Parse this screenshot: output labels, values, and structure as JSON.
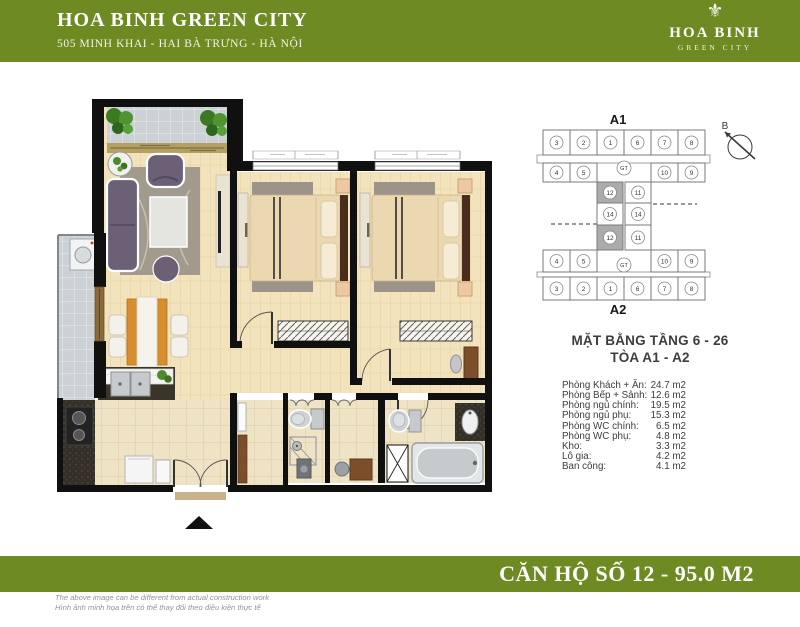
{
  "header": {
    "title": "HOA BINH GREEN CITY",
    "subtitle": "505 MINH KHAI - HAI BÀ TRƯNG - HÀ NỘI",
    "logo_name": "HOA BINH",
    "logo_tagline": "GREEN CITY",
    "emblem_glyph": "⚜"
  },
  "key_plan": {
    "a1_label": "A1",
    "a2_label": "A2",
    "compass_label": "B",
    "core_label": "GT",
    "a1_outer": [
      "3",
      "2",
      "1",
      "6",
      "7",
      "8"
    ],
    "a1_inner": [
      "4",
      "5",
      "10",
      "9"
    ],
    "a1_mid": [
      "12",
      "11"
    ],
    "mid_units": [
      "14",
      "14"
    ],
    "a2_mid": [
      "12",
      "11"
    ],
    "a2_inner": [
      "4",
      "5",
      "10",
      "9"
    ],
    "a2_outer": [
      "3",
      "2",
      "1",
      "6",
      "7",
      "8"
    ],
    "highlighted_unit": "12"
  },
  "plan_info": {
    "floor_range": "MẶT BẰNG TẦNG 6 - 26",
    "tower": "TÒA A1 - A2"
  },
  "room_table": {
    "rows": [
      {
        "label": "Phòng Khách + Ăn:",
        "value": "24.7 m2"
      },
      {
        "label": "Phòng Bếp + Sảnh:",
        "value": "12.6 m2"
      },
      {
        "label": "Phòng ngủ chính:",
        "value": "19.5 m2"
      },
      {
        "label": "Phòng ngủ phụ:",
        "value": "15.3 m2"
      },
      {
        "label": "Phòng WC chính:",
        "value": "6.5 m2"
      },
      {
        "label": "Phòng WC phụ:",
        "value": "4.8 m2"
      },
      {
        "label": "Kho:",
        "value": "3.3 m2"
      },
      {
        "label": "Lô gia:",
        "value": "4.2 m2"
      },
      {
        "label": "Ban công:",
        "value": "4.1 m2"
      }
    ]
  },
  "footer": {
    "banner": "CĂN HỘ SỐ 12 - 95.0 M2",
    "disclaimer_en": "The above image can be different from actual construction work",
    "disclaimer_vi": "Hình ảnh minh họa trên có thể thay đổi theo điều kiện thực tế"
  },
  "colors": {
    "brand_green": "#6d8a23",
    "highlight_unit_fill": "#ababab",
    "wall": "#101010"
  }
}
